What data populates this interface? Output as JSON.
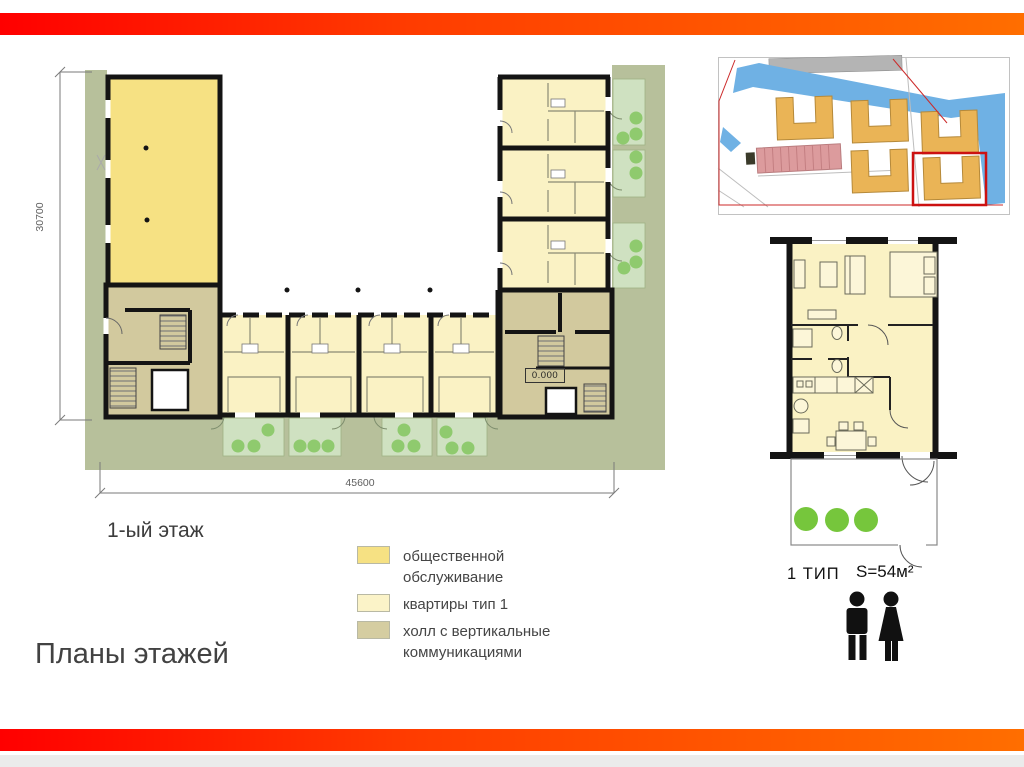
{
  "slide": {
    "title": "Планы этажей",
    "accent_gradient_start": "#ff0000",
    "accent_gradient_end": "#ff6e00"
  },
  "main_plan": {
    "floor_label": "1-ый этаж",
    "height_dimension": "30700",
    "width_dimension": "45600",
    "elevation_mark": "0.000",
    "colors": {
      "site_green": "#b7c09b",
      "public_service_yellow": "#f6e183",
      "apartment_yellow": "#faf2c4",
      "hall_khaki": "#d2c99e",
      "terrace_green": "#cfe1c1",
      "bush_green": "#8fca6e",
      "wall_black": "#141414"
    }
  },
  "legend": {
    "items": [
      {
        "label": "общественной обслуживание",
        "color": "#f6e183"
      },
      {
        "label": "квартиры тип 1",
        "color": "#fbf3c8"
      },
      {
        "label": "холл с вертикальные коммуникациями",
        "color": "#d5cda1"
      }
    ]
  },
  "site_plan": {
    "highlight_color": "#cc1111",
    "building_color": "#eab456",
    "water_color": "#6fb1e4",
    "parking_color": "#dc9b9d"
  },
  "unit_plan": {
    "type_label": "1 ТИП",
    "area_label": "S=54м²",
    "occupant_icons": [
      "man-icon",
      "woman-icon"
    ],
    "bush_color": "#76c63c"
  }
}
